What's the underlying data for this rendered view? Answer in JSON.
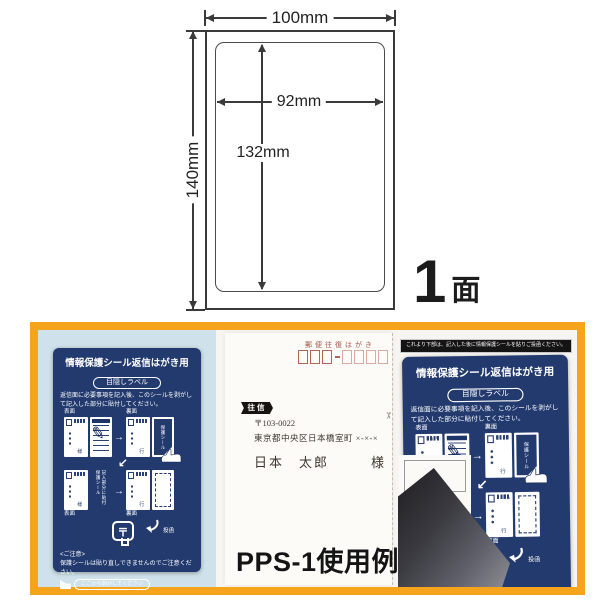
{
  "product": {
    "faces_count": "1",
    "faces_unit": "面",
    "caption": "PPS-1使用例"
  },
  "dimensions": {
    "sheet_width": "100mm",
    "sheet_height": "140mm",
    "label_width": "92mm",
    "label_height": "132mm"
  },
  "seal_card": {
    "title": "情報保護シール返信はがき用",
    "badge": "目隠しラベル",
    "instructions": "返信面に必要事項を記入後、このシールを剥がして記入した部分に貼付してください。",
    "front_label": "表面",
    "back_label": "裏面",
    "seal_vertical": "保護シール",
    "applied_vertical": "記入部分に貼付 保護シール",
    "addressee_to": "様",
    "addressee_reply": "行",
    "postmark_symbol": "〒",
    "post_label": "投函",
    "notice_title": "<ご注意>",
    "notice_text": "保護シールは貼り直しできませんのでご注意ください。",
    "peel_pill": "ここから剥がしてください"
  },
  "postcard": {
    "header": "郵便往復はがき",
    "ribbon": "往信",
    "postal_code": "〒103-0022",
    "address": "東京都中央区日本橋室町 ×-×-×",
    "name": "日本　太郎",
    "honorific": "様"
  },
  "right_panel": {
    "banner": "これより下部は、記入した後に情報保護シールを貼りご投函ください。",
    "revealed_postal": "〒103-00",
    "revealed_address": "×-×-×"
  },
  "colors": {
    "navy": "#233a6f",
    "orange": "#f6a41c",
    "photo_blue": "#cfe1ea",
    "postcard_red": "#a8564c"
  }
}
